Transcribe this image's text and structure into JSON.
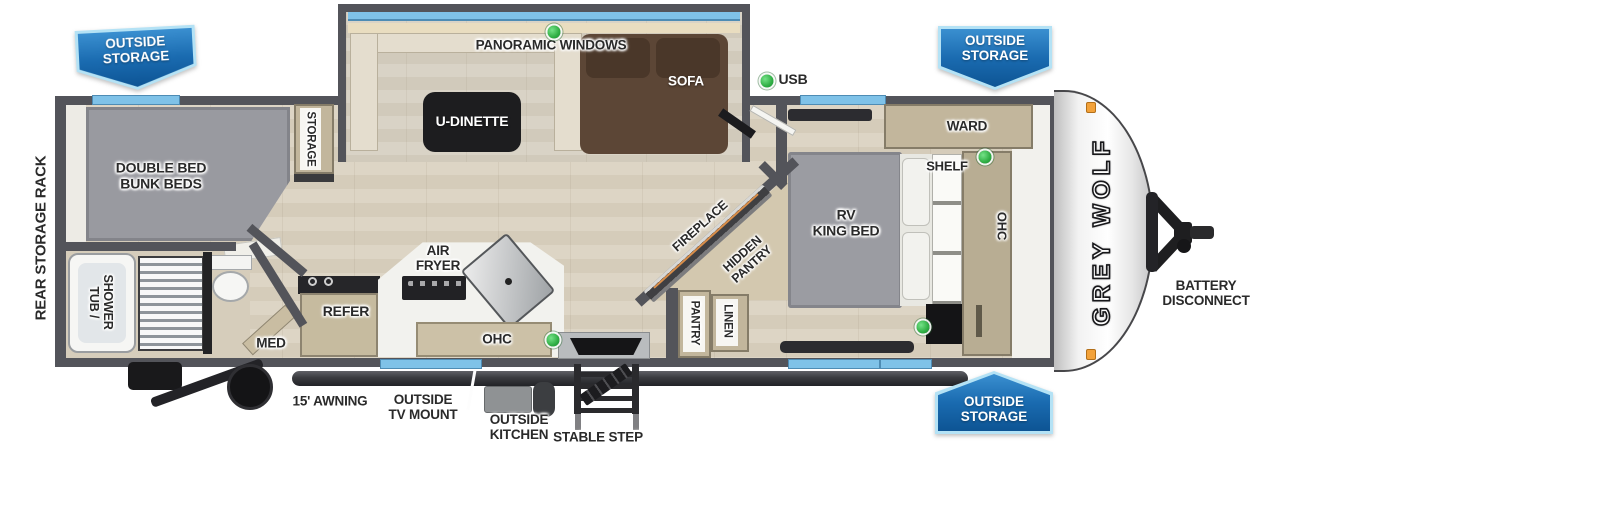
{
  "colors": {
    "banner_blue": "#1a6bb0",
    "banner_trim": "#aee0f6",
    "wall_gray": "#53545a",
    "window_blue": "#7fc2e8",
    "floor_tan": "#d9d1c0",
    "indicator_green": "#2fae44",
    "clearance_orange": "#f3a23a"
  },
  "banners": {
    "rear": "OUTSIDE\nSTORAGE",
    "front": "OUTSIDE\nSTORAGE",
    "door_side": "OUTSIDE\nSTORAGE"
  },
  "exterior": {
    "rear_storage_rack": "REAR STORAGE RACK",
    "usb": "USB",
    "awning": "15' AWNING",
    "outside_tv_mount": "OUTSIDE\nTV MOUNT",
    "outside_kitchen": "OUTSIDE\nKITCHEN",
    "stable_step": "STABLE STEP",
    "battery_disconnect": "BATTERY\nDISCONNECT",
    "brand": "GREY WOLF"
  },
  "slideout": {
    "panoramic_windows": "PANORAMIC WINDOWS",
    "u_dinette": "U-DINETTE",
    "sofa": "SOFA"
  },
  "bunk_room": {
    "bed": "DOUBLE BED\nBUNK BEDS",
    "storage": "STORAGE"
  },
  "bathroom": {
    "tub_shower": "TUB /\nSHOWER",
    "med": "MED"
  },
  "kitchen": {
    "refer": "REFER",
    "air_fryer": "AIR\nFRYER",
    "ohc": "OHC"
  },
  "living": {
    "fireplace": "FIREPLACE",
    "hidden_pantry": "HIDDEN\nPANTRY",
    "pantry": "PANTRY",
    "linen": "LINEN"
  },
  "bedroom": {
    "ward": "WARD",
    "shelf": "SHELF",
    "bed": "RV\nKING BED",
    "ohc": "OHC"
  }
}
